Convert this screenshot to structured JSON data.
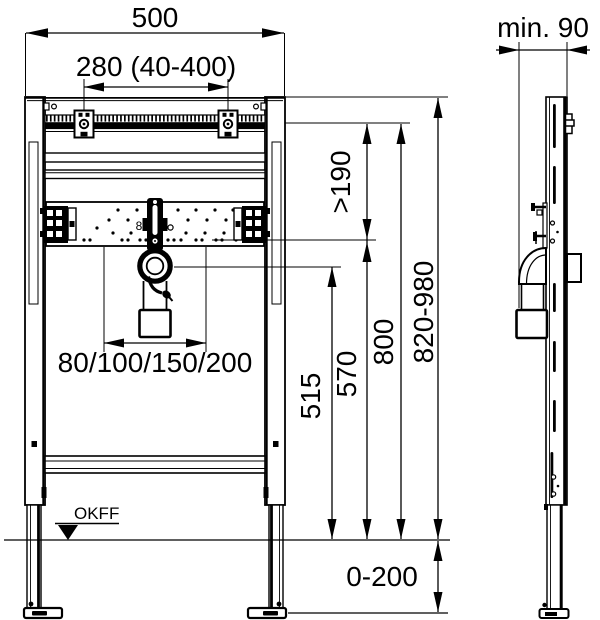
{
  "dims": {
    "width": "500",
    "fixing_spacing": "280 (40-400)",
    "depth_min": "min. 90",
    "clearance_min": ">190",
    "rail_height": "800",
    "frame_height": "820-980",
    "trap_bracket_height": "570",
    "drain_height": "515",
    "drain_offsets": "80/100/150/200",
    "leg_adjust_range": "0-200"
  },
  "labels": {
    "floor_level": "OKFF",
    "plate_marking": "8"
  }
}
